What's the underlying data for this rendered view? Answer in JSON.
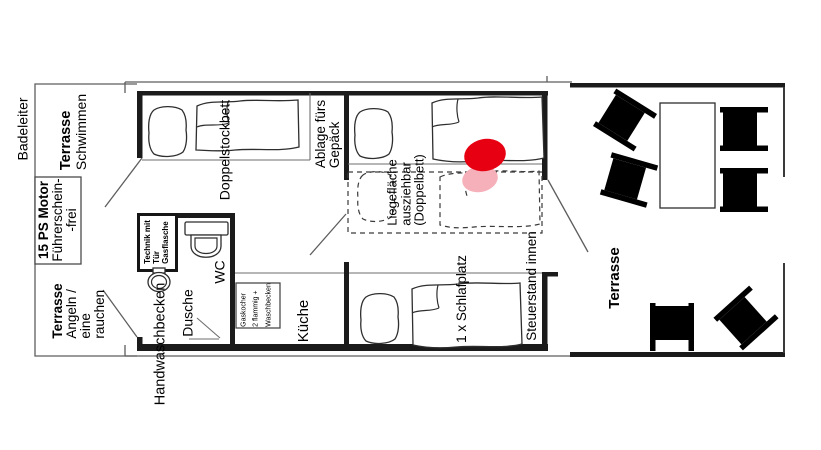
{
  "plan": {
    "bow": {
      "ladder": "Badeleiter",
      "terrace_swim": {
        "title": "Terrasse",
        "line2": "Schwimmen"
      },
      "motor": {
        "line1": "15 PS Motor",
        "line2": "Führerschein-",
        "line3": "-frei"
      },
      "terrace_fish": {
        "title": "Terrasse",
        "line2": "Angeln /",
        "line3": "eine",
        "line4": "rauchen"
      }
    },
    "cabin": {
      "bunk": "Doppelstockbett",
      "luggage": {
        "line1": "Ablage fürs",
        "line2": "Gepäck"
      },
      "technik": {
        "line1": "Technik mit",
        "line2": "Tür",
        "line3": "Gasflasche"
      },
      "wc": "WC",
      "sink": "Handwaschbecken",
      "shower": "Dusche",
      "stove": {
        "line1": "Gaskocher",
        "line2": "2 flammig +",
        "line3": "Waschbecken"
      },
      "kitchen": "Küche",
      "lounge": {
        "line1": "Liegefläche",
        "line2": "ausziehbar",
        "line3": "(Doppelbett)"
      },
      "sleep": "1 x Schlafplatz",
      "helm": "Steuerstand innen"
    },
    "stern_terrace": {
      "title": "Terrasse"
    },
    "colors": {
      "marker_red": "#e60012",
      "marker_pink": "#f6b0ba",
      "wall": "#1b1b1b"
    }
  }
}
